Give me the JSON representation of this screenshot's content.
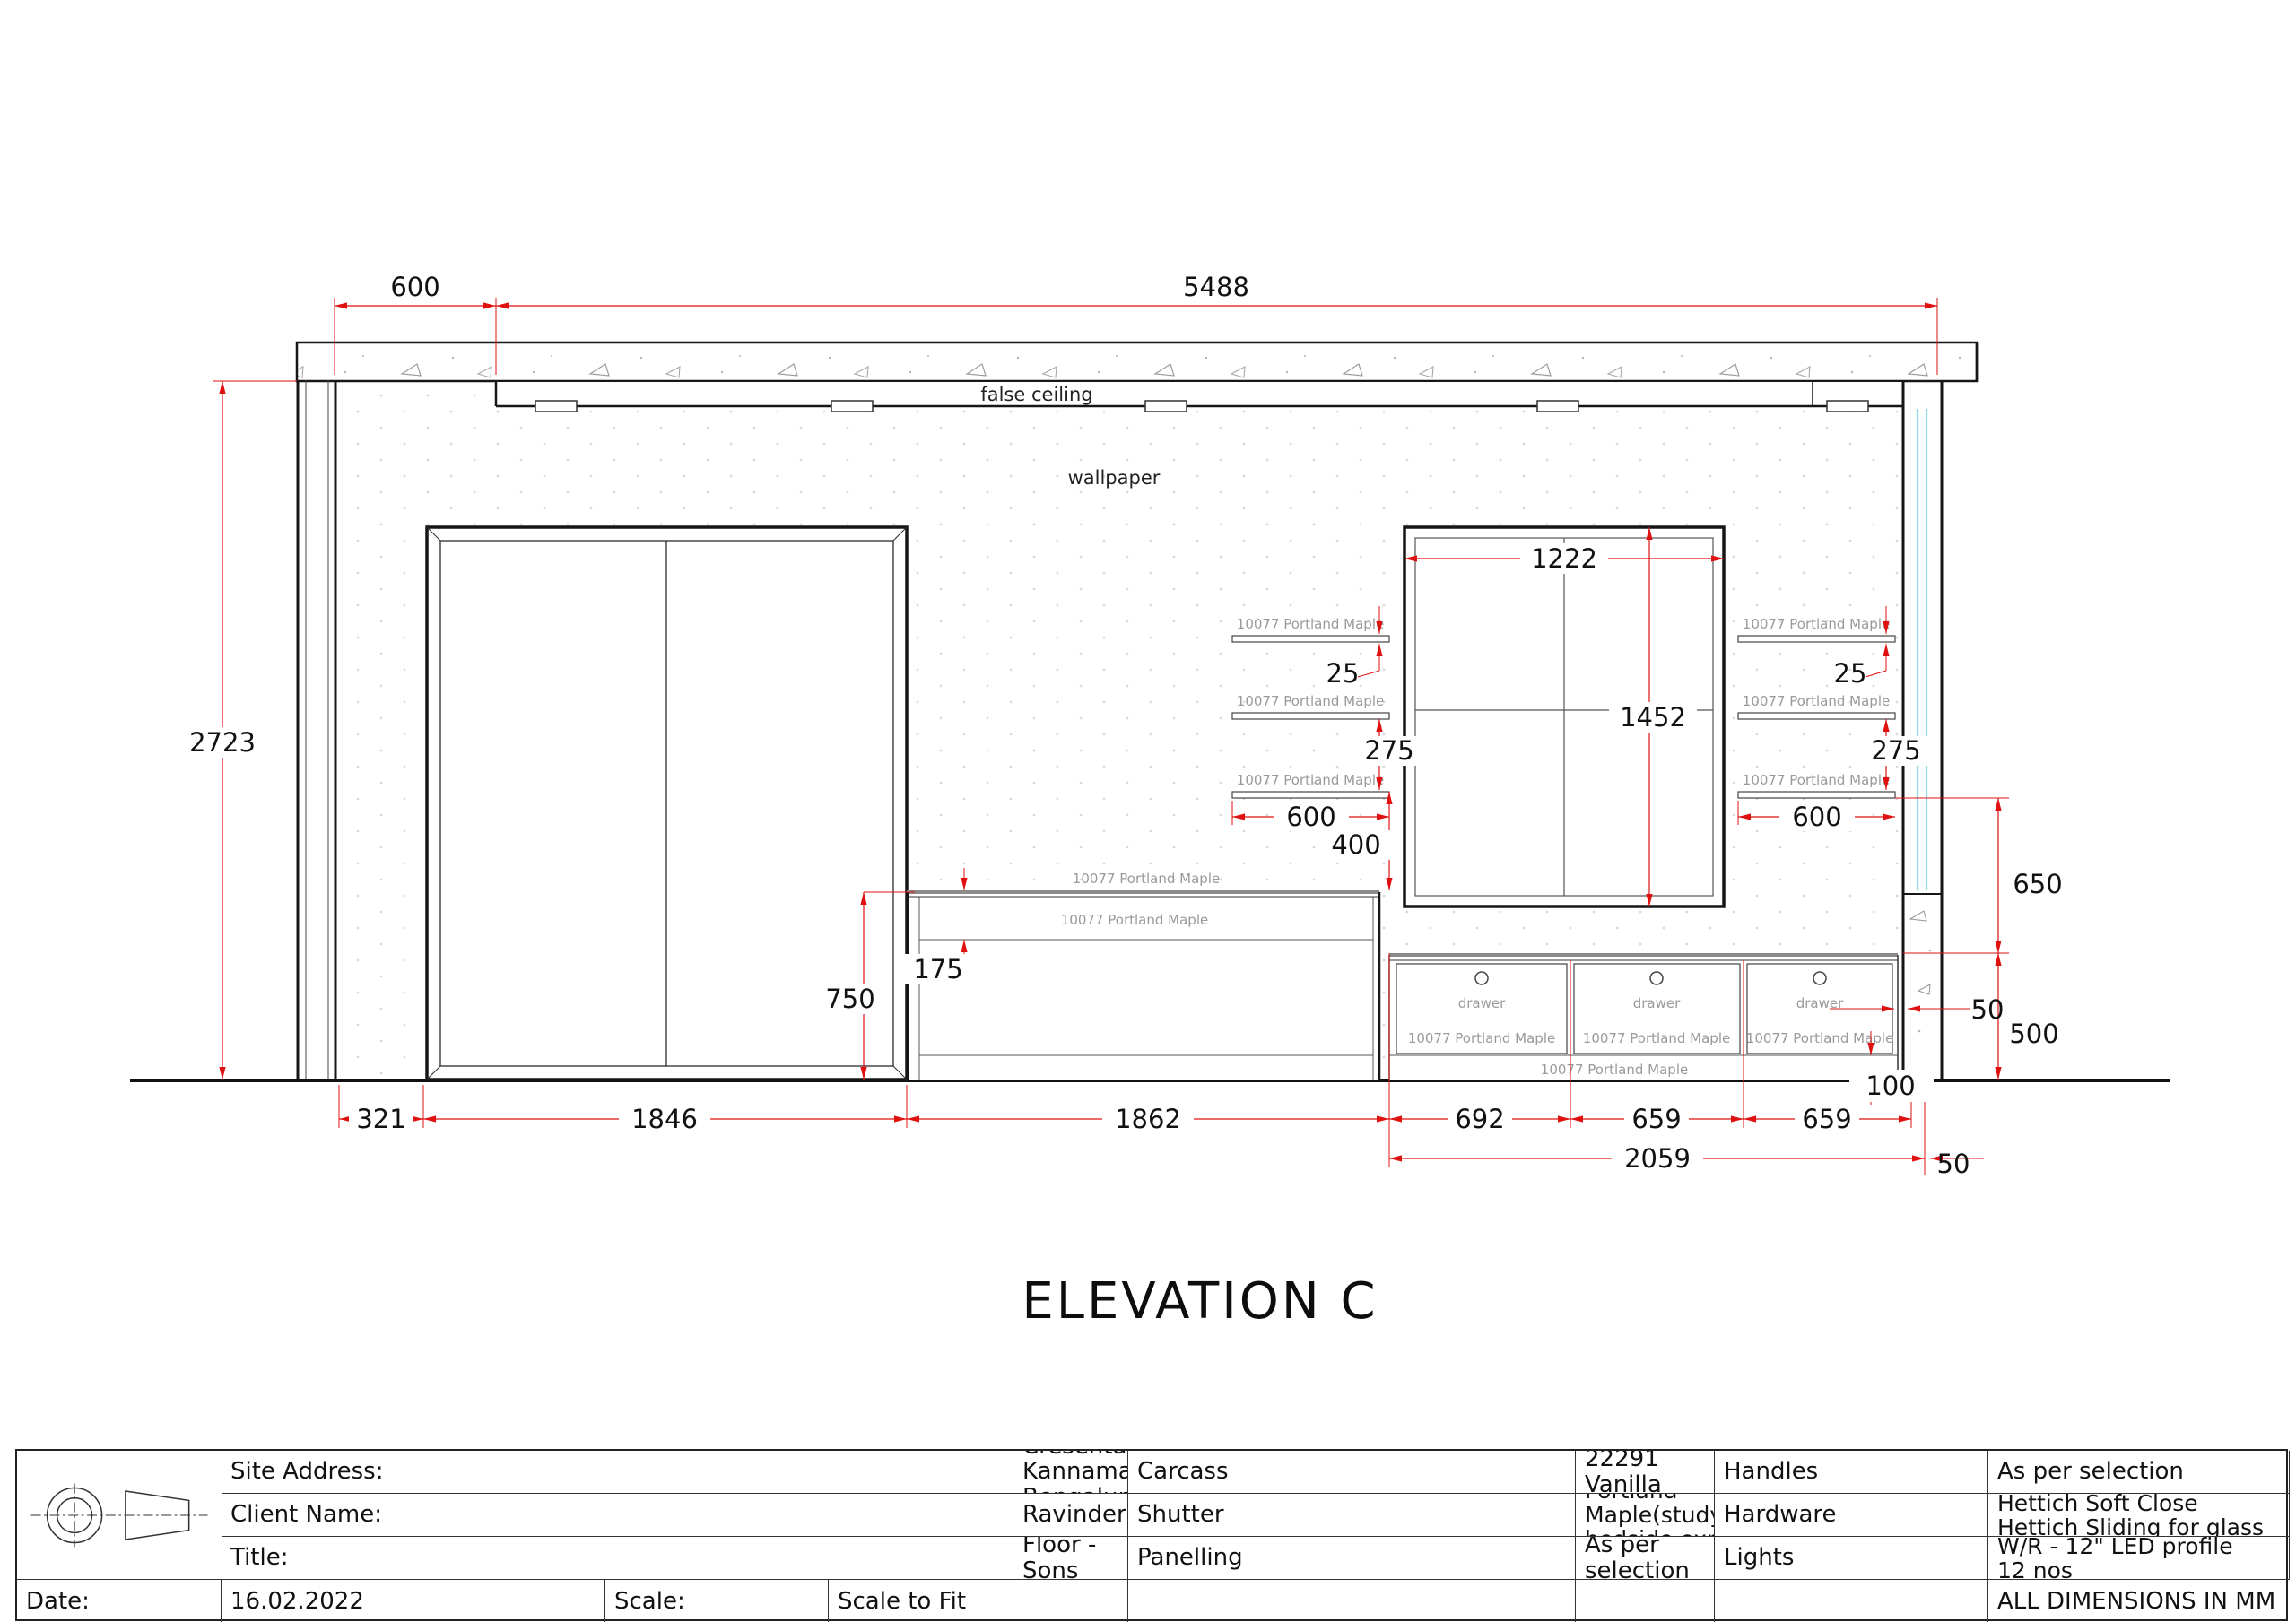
{
  "drawing": {
    "elevation_label": "ELEVATION C",
    "false_ceiling": "false ceiling",
    "wallpaper": "wallpaper",
    "material_label": "10077 Portland Maple",
    "drawer_label": "drawer"
  },
  "dimensions": {
    "ceiling_offset": "600",
    "wall_span": "5488",
    "wall_height": "2723",
    "panel_width": "1222",
    "panel_height": "1452",
    "shelf_thickness": "25",
    "shelf_gap": "275",
    "shelf_width": "600",
    "shelf_to_desk": "400",
    "desk_height": "750",
    "desk_apron": "175",
    "shelf_to_unit": "650",
    "unit_height": "500",
    "unit_wall_gap": "50",
    "plinth_height": "100",
    "chain": [
      "321",
      "1846",
      "1862",
      "692",
      "659",
      "659"
    ],
    "unit_run": "2059",
    "end_offset": "50"
  },
  "colors": {
    "dimension_red": "#e01010",
    "glass_cyan": "#8fd8e8",
    "material_gray": "#9a9a9a"
  },
  "title_block": {
    "site_address_label": "Site Address:",
    "site_address_value": "Villa 10, MIMS Cresenta, Kannamangala, Bengaluru 560067",
    "client_name_label": "Client Name:",
    "client_name_value": "Ravinder",
    "title_label": "Title:",
    "title_value": "First Floor - Sons Bedroom",
    "date_label": "Date:",
    "date_value": "16.02.2022",
    "scale_label": "Scale:",
    "scale_value": "Scale to Fit",
    "carcass_label": "Carcass",
    "carcass_value": "Ply + 22291 Vanilla White",
    "shutter_label": "Shutter",
    "shutter_value": "Ply+10077 Portland Maple(study,loft, bedside,exposed sides)",
    "panelling_label": "Panelling",
    "panelling_value": "As per selection",
    "handles_label": "Handles",
    "handles_value": "As per selection",
    "hardware_label": "Hardware",
    "hardware_value_1": "Hettich Soft Close",
    "hardware_value_2": "Hettich Sliding for glass",
    "lights_label": "Lights",
    "lights_value_1": "W/R - 12\" LED profile",
    "lights_value_2": "12 nos",
    "all_dimensions_note": "ALL DIMENSIONS IN MM"
  }
}
